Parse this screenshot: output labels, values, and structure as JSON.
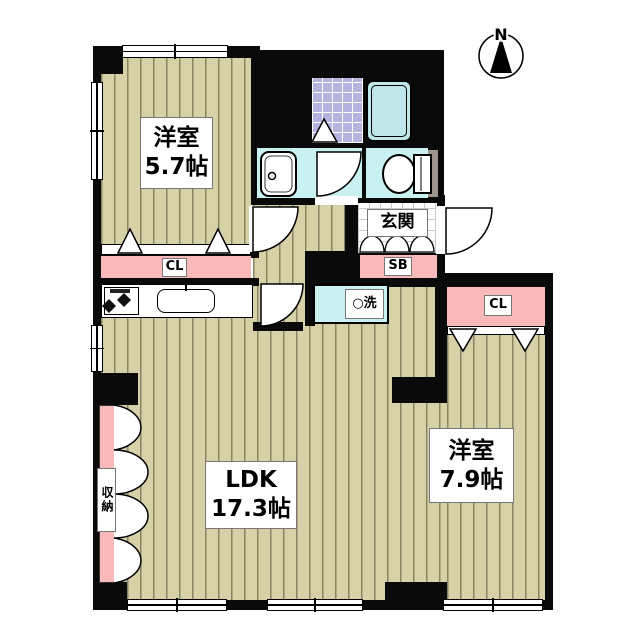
{
  "plan": {
    "compass_label": "N",
    "rooms": {
      "bedroom1": {
        "name": "洋室",
        "size": "5.7帖"
      },
      "ldk": {
        "name": "LDK",
        "size": "17.3帖"
      },
      "bedroom2": {
        "name": "洋室",
        "size": "7.9帖"
      }
    },
    "labels": {
      "entrance": "玄関",
      "shoe_box": "SB",
      "closet_top": "CL",
      "closet_right": "CL",
      "laundry": "○洗",
      "storage": "収納"
    },
    "icons": {
      "compass": "north-compass-icon",
      "bathtub": "bathtub-icon",
      "bath_floor": "bath-tile-icon",
      "toilet": "toilet-icon",
      "washbasin": "washbasin-icon",
      "kitchen_sink": "kitchen-sink-icon",
      "stove": "stove-icon",
      "doors": "door-swing-icon",
      "storage_doors": "accordion-door-icon"
    },
    "colors": {
      "wall": "#0a0a0a",
      "wood_floor": "#d7d1a8",
      "closet_pink": "#f7b9b9",
      "wet_area_cyan": "#c9f1f1",
      "bath_tile_purple": "#b7b3e0",
      "bathtub_blue": "#bfe6e9",
      "toilet_door_gray": "#9e968c"
    }
  }
}
